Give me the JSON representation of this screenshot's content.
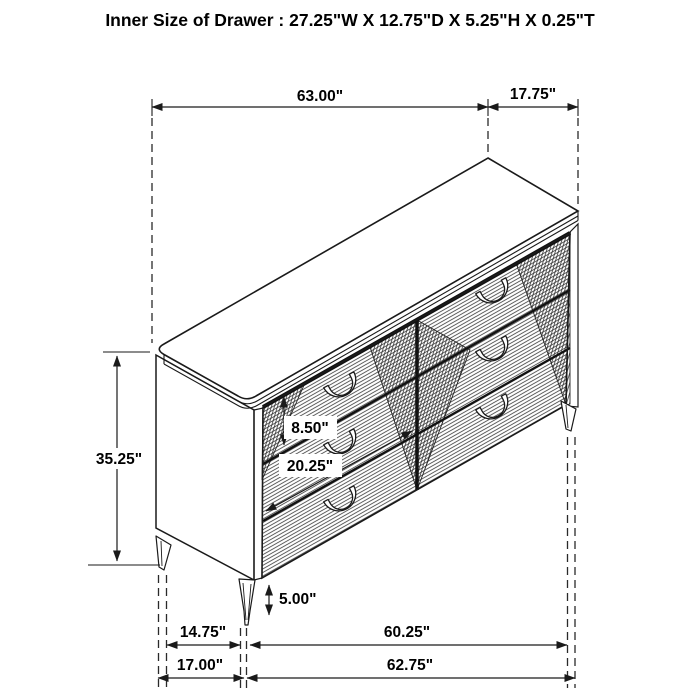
{
  "title": "Inner Size of Drawer : 27.25\"W X 12.75\"D X 5.25\"H X 0.25\"T",
  "dimensions": {
    "top_width": "63.00\"",
    "top_depth": "17.75\"",
    "overall_height": "35.25\"",
    "drawer_front_height": "8.50\"",
    "drawer_front_width": "20.25\"",
    "leg_height": "5.00\"",
    "leg_span_side": "14.75\"",
    "leg_span_front": "60.25\"",
    "base_depth": "17.00\"",
    "base_width": "62.75\""
  },
  "colors": {
    "line": "#1a1a1a",
    "background": "#ffffff"
  }
}
